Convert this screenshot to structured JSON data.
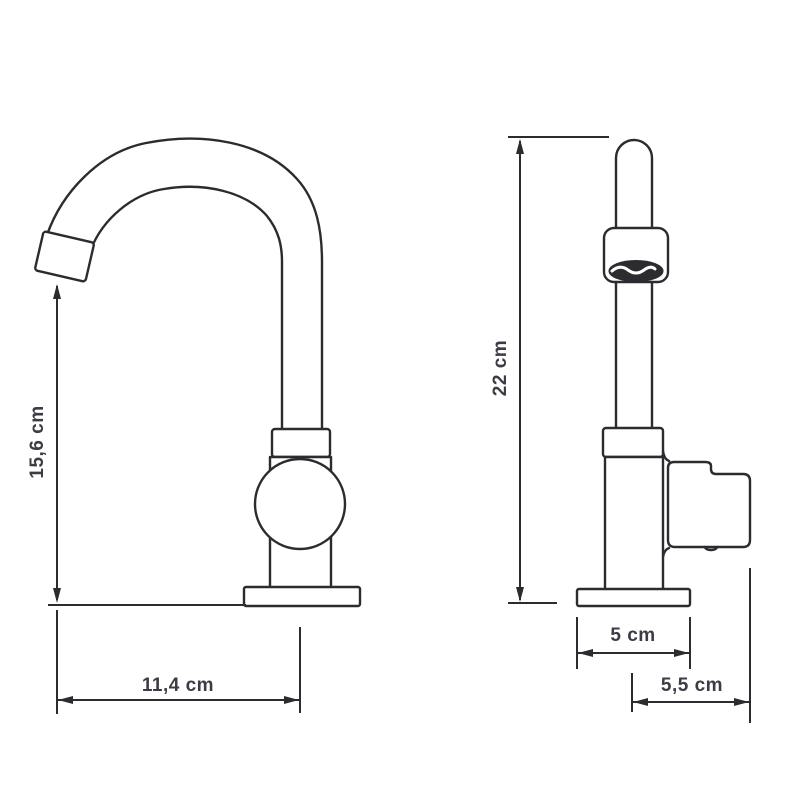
{
  "drawing": {
    "kind": "tap-two-view-dimensional-diagram",
    "colors": {
      "background": "#ffffff",
      "line": "#2b2b30",
      "text": "#3c3c46"
    },
    "dimensions": {
      "left_view": {
        "spout_height": "15,6 cm",
        "spout_reach": "11,4 cm"
      },
      "right_view": {
        "total_height": "22 cm",
        "base_width": "5 cm",
        "handle_depth": "5,5 cm"
      }
    }
  }
}
